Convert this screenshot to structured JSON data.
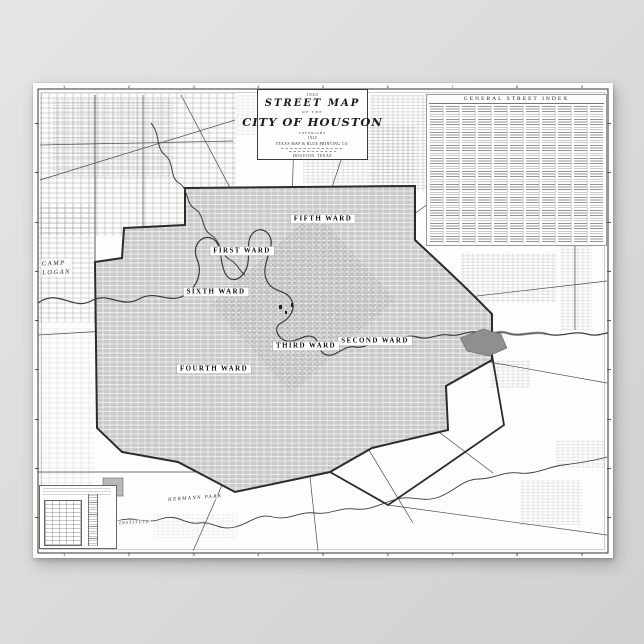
{
  "poster": {
    "title_block": {
      "year_top": "1920",
      "title": "STREET MAP",
      "of_the": "OF THE",
      "city": "CITY OF HOUSTON",
      "copyright": "COPYRIGHT",
      "year": "1920",
      "publisher": "TEXAS MAP & BLUE PRINTING CO.",
      "place": "HOUSTON, TEXAS"
    },
    "street_index": {
      "title": "GENERAL STREET INDEX",
      "column_count": 11
    },
    "wards": [
      {
        "label": "FIFTH WARD"
      },
      {
        "label": "FIRST WARD"
      },
      {
        "label": "SIXTH WARD"
      },
      {
        "label": "SECOND WARD"
      },
      {
        "label": "THIRD WARD"
      },
      {
        "label": "FOURTH WARD"
      }
    ],
    "places": {
      "camp": "CAMP",
      "logan": "LOGAN",
      "hermann_park": "HERMANN PARK",
      "rice_institute": "RICE INSTITUTE"
    },
    "border_ticks": [
      "1",
      "2",
      "3",
      "4",
      "5",
      "6",
      "7",
      "8",
      "9"
    ],
    "colors": {
      "city_shade": "#c9c9c9",
      "boundary": "#2b2b2b",
      "water": "#3c3c3c",
      "paper": "#fcfcfa",
      "background": "#dedcda"
    }
  }
}
